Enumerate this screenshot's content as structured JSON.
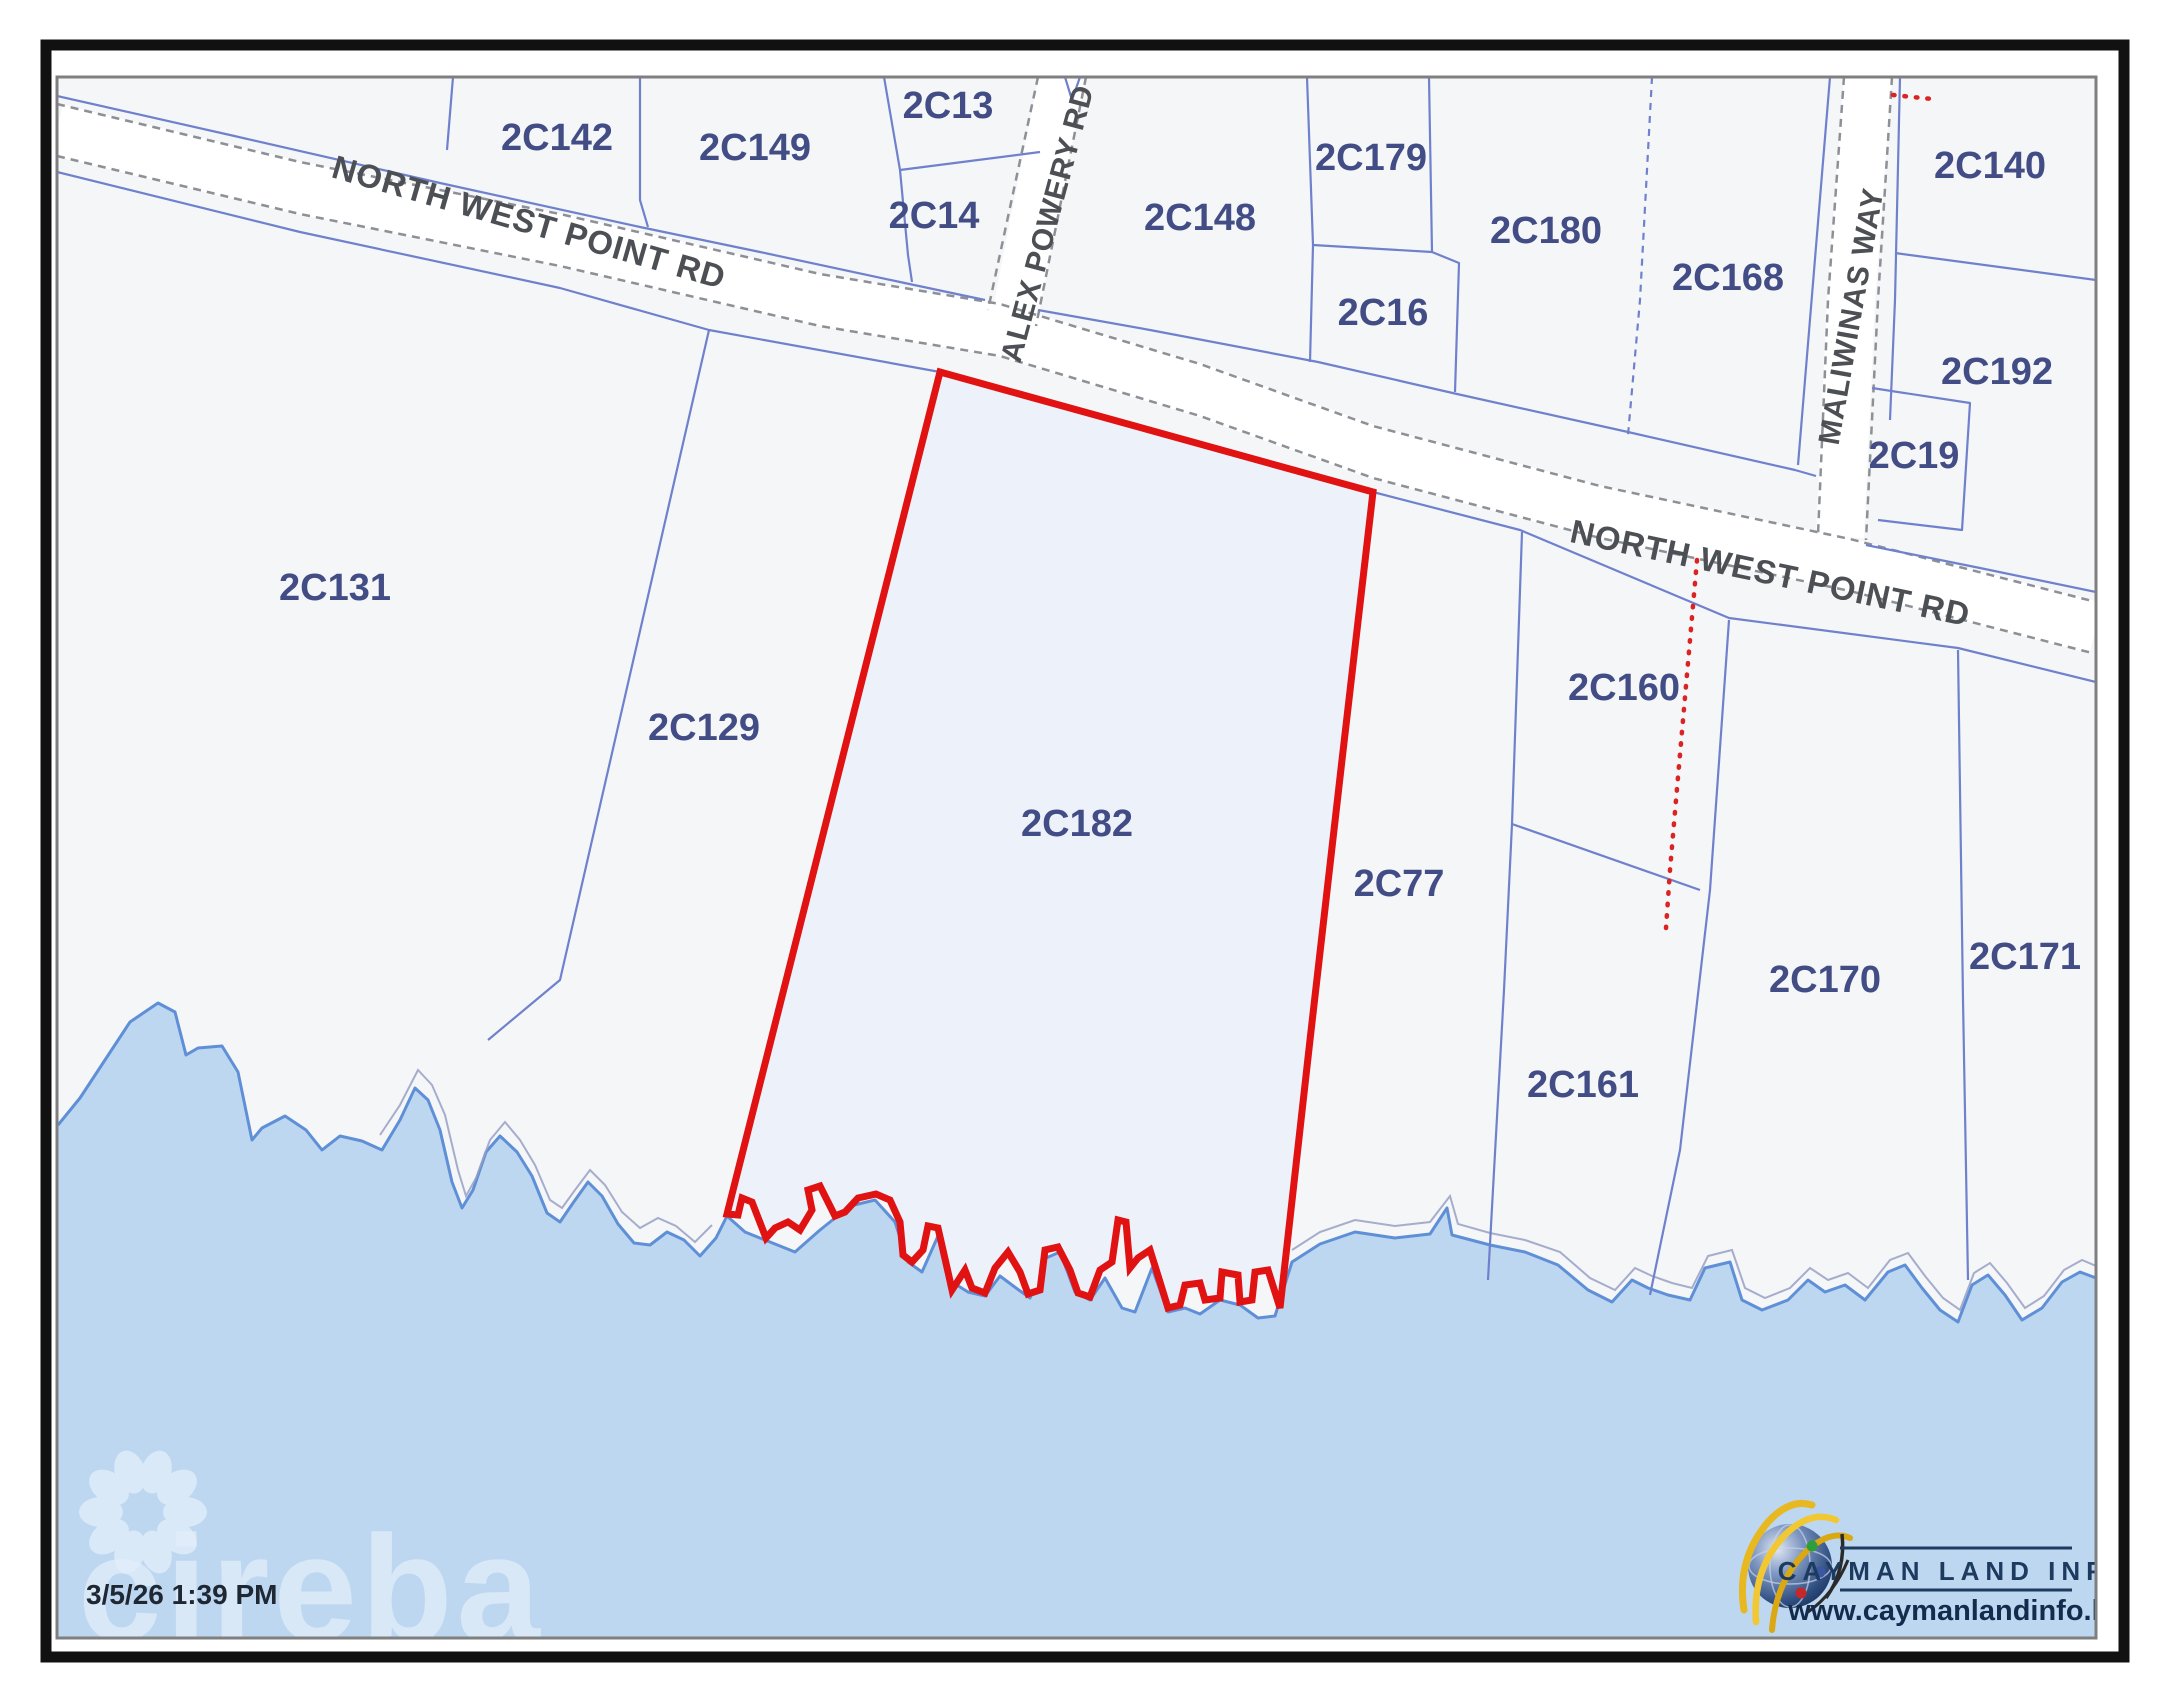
{
  "map": {
    "timestamp": "3/5/26 1:39 PM",
    "watermark": "cireba",
    "highlighted_parcel": "2C182",
    "colors": {
      "land_fill": "#f5f6f8",
      "water_fill": "#bdd7f1",
      "coast_stroke": "#5f8fd6",
      "inland_line": "#98a0c4",
      "parcel_line": "#6f81cc",
      "parcel_label": "#434d85",
      "road_casing": "#8d9096",
      "road_fill": "#ffffff",
      "road_label": "#4c4f54",
      "highlight_red": "#e01212",
      "highlight_fill": "#edf2fa",
      "frame_black": "#111111",
      "map_border": "#7f7f7f",
      "timestamp_color": "#1f2733",
      "logo_navy": "#1d3a5f"
    },
    "parcel_labels": [
      {
        "id": "2C142",
        "x": 557,
        "y": 150
      },
      {
        "id": "2C149",
        "x": 755,
        "y": 160
      },
      {
        "id": "2C13",
        "x": 948,
        "y": 118
      },
      {
        "id": "2C14",
        "x": 934,
        "y": 228
      },
      {
        "id": "2C148",
        "x": 1200,
        "y": 230
      },
      {
        "id": "2C179",
        "x": 1371,
        "y": 170
      },
      {
        "id": "2C16",
        "x": 1383,
        "y": 325
      },
      {
        "id": "2C180",
        "x": 1546,
        "y": 243
      },
      {
        "id": "2C168",
        "x": 1728,
        "y": 290
      },
      {
        "id": "2C140",
        "x": 1990,
        "y": 178
      },
      {
        "id": "2C192",
        "x": 1997,
        "y": 384
      },
      {
        "id": "2C19",
        "x": 1914,
        "y": 468
      },
      {
        "id": "2C131",
        "x": 335,
        "y": 600
      },
      {
        "id": "2C129",
        "x": 704,
        "y": 740
      },
      {
        "id": "2C182",
        "x": 1077,
        "y": 836
      },
      {
        "id": "2C77",
        "x": 1399,
        "y": 896
      },
      {
        "id": "2C160",
        "x": 1624,
        "y": 700
      },
      {
        "id": "2C161",
        "x": 1583,
        "y": 1097
      },
      {
        "id": "2C170",
        "x": 1825,
        "y": 992
      },
      {
        "id": "2C171",
        "x": 2025,
        "y": 969
      }
    ],
    "road_labels": [
      {
        "text": "NORTH WEST POINT RD",
        "x": 526,
        "y": 233,
        "angle": 16,
        "size": 33
      },
      {
        "text": "NORTH WEST POINT RD",
        "x": 1768,
        "y": 584,
        "angle": 12,
        "size": 33
      },
      {
        "text": "ALEX POWERY RD",
        "x": 1057,
        "y": 226,
        "angle": -75,
        "size": 30
      },
      {
        "text": "MALIWINAS WAY",
        "x": 1861,
        "y": 318,
        "angle": -80,
        "size": 30
      }
    ],
    "logo": {
      "title": "CAYMAN LAND INFO",
      "url": "www.caymanlandinfo.ky"
    }
  }
}
